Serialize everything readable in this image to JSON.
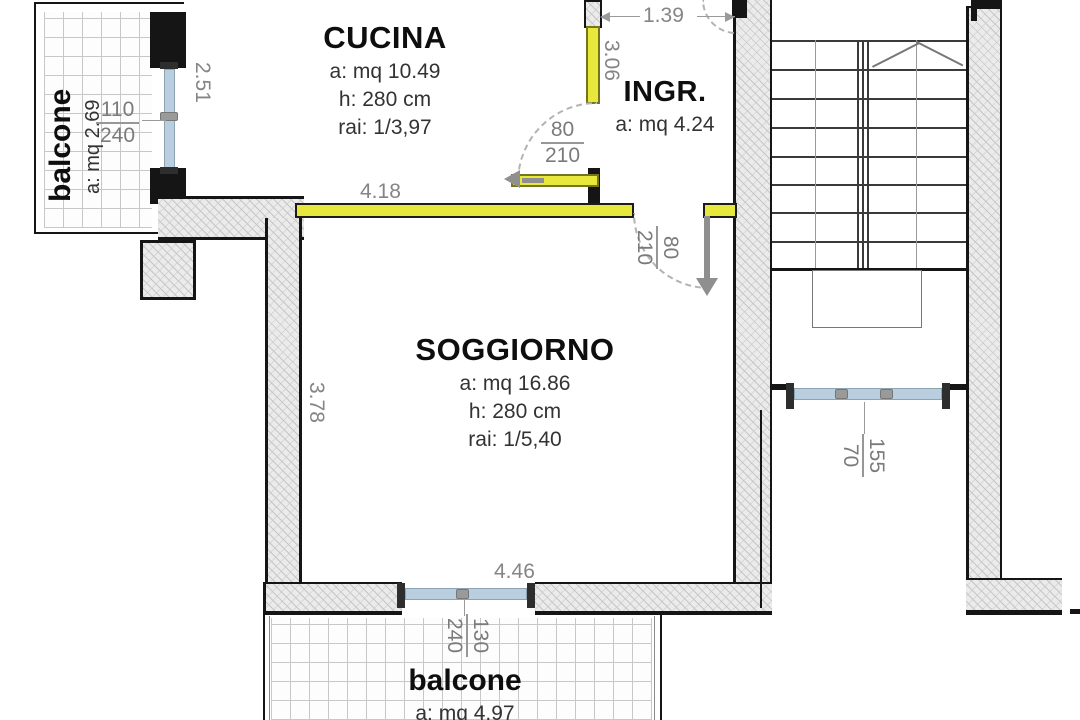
{
  "rooms": {
    "cucina": {
      "name": "CUCINA",
      "area": "a: mq 10.49",
      "height": "h: 280 cm",
      "rai": "rai: 1/3,97"
    },
    "ingresso": {
      "name": "INGR.",
      "area": "a: mq 4.24"
    },
    "soggiorno": {
      "name": "SOGGIORNO",
      "area": "a: mq 16.86",
      "height": "h: 280 cm",
      "rai": "rai: 1/5,40"
    },
    "balcone_top": {
      "name": "balcone",
      "area": "a: mq 2.69"
    },
    "balcone_bottom": {
      "name": "balcone",
      "area": "a: mq 4.97"
    }
  },
  "dims": {
    "balcone_window": {
      "num": "110",
      "den": "240"
    },
    "kitchen_left": "2.51",
    "kitchen_bottom_wall": "4.18",
    "entry_width": "1.39",
    "entry_wall": "3.06",
    "kitchen_door": {
      "num": "80",
      "den": "210"
    },
    "living_door": {
      "num": "80",
      "den": "210"
    },
    "living_left": "3.78",
    "living_window_wall": "4.46",
    "living_window": {
      "num": "130",
      "den": "240"
    },
    "stair_window": {
      "num": "155",
      "den": "70"
    }
  },
  "colors": {
    "highlight_wall": "#e8e73c",
    "window": "#b9cfdf",
    "wall_hatch": "#ebebeb",
    "wall_black": "#151515",
    "dim_text": "#858585"
  }
}
